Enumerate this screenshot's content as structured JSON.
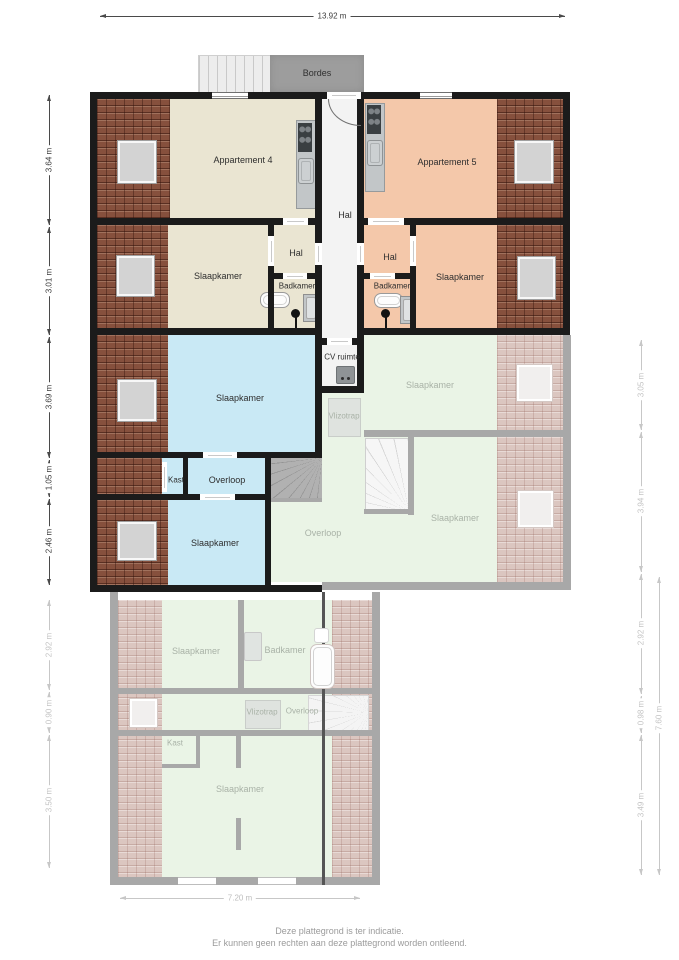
{
  "labels": {
    "bordes": "Bordes",
    "apartment4": "Appartement 4",
    "apartment5": "Appartement 5",
    "hal_center": "Hal",
    "hal_left": "Hal",
    "hal_right": "Hal",
    "badkamer_left": "Badkamer",
    "badkamer_right": "Badkamer",
    "slaapkamer_left": "Slaapkamer",
    "slaapkamer_right": "Slaapkamer",
    "slaapkamer_blue_large": "Slaapkamer",
    "slaapkamer_blue_bottom": "Slaapkamer",
    "cv_ruimte": "CV ruimte",
    "kast": "Kast",
    "overloop": "Overloop"
  },
  "faded_labels": {
    "vlizotrap_upper": "Vlizotrap",
    "slaapkamer_right_upper": "Slaapkamer",
    "slaapkamer_right_lower": "Slaapkamer",
    "overloop_upper": "Overloop",
    "slaapkamer_lower_left": "Slaapkamer",
    "badkamer_lower": "Badkamer",
    "vlizotrap_lower": "Vlizotrap",
    "overloop_lower": "Overloop",
    "kast_lower": "Kast",
    "slaapkamer_lower_big": "Slaapkamer"
  },
  "dimensions": {
    "top": "13.92 m",
    "left_active": [
      "3.64 m",
      "3.01 m",
      "3.69 m",
      "1.05 m",
      "2.46 m"
    ],
    "left_faded": [
      "2.92 m",
      "0.90 m",
      "3.50 m"
    ],
    "right_faded": [
      "3.05 m",
      "3.94 m",
      "2.92 m",
      "0.98 m",
      "3.49 m"
    ],
    "right_total": "7.60 m",
    "bottom": "7.20 m"
  },
  "footer": {
    "line1": "Deze plattegrond is ter indicatie.",
    "line2": "Er kunnen geen rechten aan deze plattegrond worden ontleend."
  },
  "colors": {
    "wall": "#1b1b1b",
    "wall_faded": "#a8a8a8",
    "roof_brick": "#86503d",
    "roof_brick_faded": "#dbc6c0",
    "floor_apartment4": "#eae5d2",
    "floor_apartment5": "#f4c8aa",
    "floor_blue": "#c9e9f5",
    "floor_green_faded": "#eaf4e6",
    "floor_hall": "#f3f3f3",
    "bordes_gray": "#9d9d9d"
  }
}
